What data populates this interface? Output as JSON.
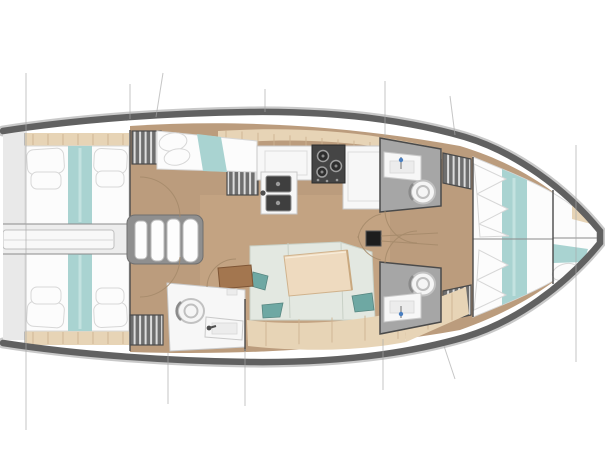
{
  "figure": {
    "type": "sailing-yacht interior floor plan, top view, bow to the right",
    "areas": [
      "aft cabin port",
      "aft cabin starboard",
      "engine compartment hatch",
      "companionway stairs",
      "pilot berth",
      "galley with sink and stove",
      "saloon with table and L-sofa",
      "aft head with toilet and sink",
      "forward head port",
      "forward head starboard",
      "hanging wardrobes",
      "forward owner cabin with V-bed",
      "bow locker berth",
      "mast step with rigging"
    ]
  },
  "palette": {
    "hull_band": "#616161",
    "hull_outline": "#c9c9c9",
    "wall": "#4a4a4a",
    "deck_floor": "#bb9c7d",
    "deck_floor_light": "#cfae8a",
    "stern_platform": "#e9e9e9",
    "shelf_beige": "#e7d4b6",
    "shelf_seam": "#cdb391",
    "bed_white": "#fcfcfc",
    "bed_shadow": "#d7d7d7",
    "teal": "#a9d3d1",
    "sofa_seat": "#e3e8e1",
    "sofa_seam": "#c8d0c6",
    "pillow_teal": "#6ea8a3",
    "pillow_teal_dark": "#578680",
    "table_wood": "#eedabf",
    "table_edge": "#d0b28c",
    "side_table": "#a3764f",
    "side_table_edge": "#7e5535",
    "wardrobe_dark": "#6e6e6e",
    "wardrobe_stripe": "#dcdcdc",
    "head_floor": "#a6a6a6",
    "fixture_white": "#f7f7f7",
    "fixture_outline": "#c9c9c9",
    "stove_dark": "#454545",
    "burner": "#9e9e9e",
    "mast": "#1d1d1d",
    "stair_frame": "#8f8f8f",
    "stair_step": "#fdfdfd",
    "door_arc": "#a5896a",
    "rigging": "#a8a8a8",
    "engine_band": "#ededed",
    "hatch": "#f8f8f8",
    "faucet_blue": "#4a7fc1",
    "background": "#ffffff"
  }
}
